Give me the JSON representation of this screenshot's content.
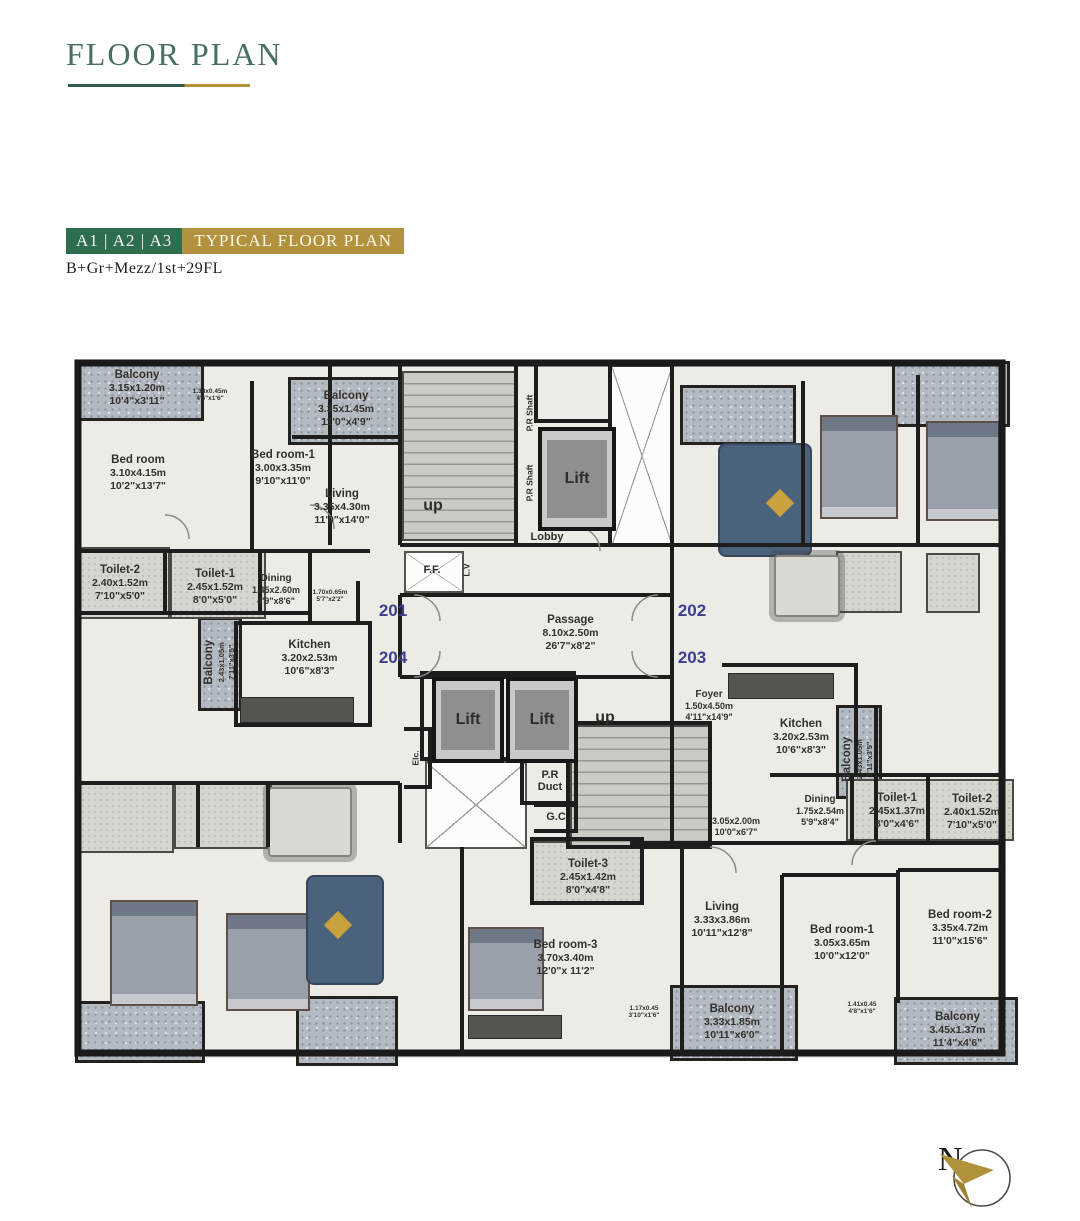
{
  "header": {
    "title": "FLOOR PLAN",
    "units_badge": "A1 | A2 | A3",
    "type_badge": "TYPICAL FLOOR PLAN",
    "floors": "B+Gr+Mezz/1st+29FL"
  },
  "compass": {
    "north_label": "N"
  },
  "colors": {
    "brand_green": "#2d6e4e",
    "brand_gold": "#b2923e",
    "title_green": "#47705e",
    "unit_number_blue": "#3d3e8e"
  },
  "plan": {
    "lift_label": "Lift",
    "unit_numbers": [
      {
        "label": "201",
        "x": 302,
        "y": 243,
        "w": 42,
        "h": 26
      },
      {
        "label": "204",
        "x": 302,
        "y": 290,
        "w": 42,
        "h": 26
      },
      {
        "label": "202",
        "x": 601,
        "y": 243,
        "w": 42,
        "h": 26
      },
      {
        "label": "203",
        "x": 601,
        "y": 290,
        "w": 42,
        "h": 26
      }
    ],
    "lifts": [
      {
        "x": 468,
        "y": 72,
        "w": 70,
        "h": 96
      },
      {
        "x": 362,
        "y": 322,
        "w": 64,
        "h": 78
      },
      {
        "x": 436,
        "y": 322,
        "w": 64,
        "h": 78
      }
    ],
    "service_labels": [
      {
        "label": "up",
        "x": 340,
        "y": 138,
        "w": 46,
        "h": 26,
        "big": true
      },
      {
        "label": "up",
        "x": 512,
        "y": 350,
        "w": 46,
        "h": 26,
        "big": true
      },
      {
        "label": "P.R Shaft",
        "x": 448,
        "y": 28,
        "w": 22,
        "h": 60,
        "vertical": true
      },
      {
        "label": "P.R Shaft",
        "x": 448,
        "y": 96,
        "w": 22,
        "h": 64,
        "vertical": true
      },
      {
        "label": "Lobby",
        "x": 448,
        "y": 172,
        "w": 58,
        "h": 20
      },
      {
        "label": "F.F.",
        "x": 336,
        "y": 197,
        "w": 52,
        "h": 36
      },
      {
        "label": "L.V",
        "x": 388,
        "y": 198,
        "w": 18,
        "h": 34,
        "vertical": true
      },
      {
        "label": "P.R\nDuct",
        "x": 454,
        "y": 404,
        "w": 52,
        "h": 44
      },
      {
        "label": "G.C",
        "x": 466,
        "y": 450,
        "w": 40,
        "h": 24
      },
      {
        "label": "Elc.",
        "x": 334,
        "y": 376,
        "w": 24,
        "h": 54,
        "vertical": true
      }
    ],
    "rooms": [
      {
        "name": "Balcony",
        "m": "3.15x1.20m",
        "ft": "10'4\"x3'11\"",
        "x": 8,
        "y": 8,
        "w": 118,
        "h": 50,
        "type": "balcony"
      },
      {
        "name": "",
        "m": "1.38x0.45m",
        "ft": "4'6\"x1'6\"",
        "x": 112,
        "y": 26,
        "w": 56,
        "h": 28,
        "type": "tiny"
      },
      {
        "name": "Bed room",
        "m": "3.10x4.15m",
        "ft": "10'2\"x13'7\"",
        "x": 12,
        "y": 88,
        "w": 112,
        "h": 60,
        "type": "room"
      },
      {
        "name": "Bed room-1",
        "m": "3.00x3.35m",
        "ft": "9'10\"x11'0\"",
        "x": 158,
        "y": 83,
        "w": 110,
        "h": 60,
        "type": "room"
      },
      {
        "name": "Balcony",
        "m": "3.35x1.45m",
        "ft": "11'0\"x4'9\"",
        "x": 222,
        "y": 28,
        "w": 108,
        "h": 52,
        "type": "balcony"
      },
      {
        "name": "Living",
        "m": "3.35x4.30m",
        "ft": "11'0\"x14'0\"",
        "x": 218,
        "y": 122,
        "w": 108,
        "h": 60,
        "type": "room"
      },
      {
        "name": "Toilet-2",
        "m": "2.40x1.52m",
        "ft": "7'10\"x5'0\"",
        "x": 6,
        "y": 200,
        "w": 88,
        "h": 56,
        "type": "room"
      },
      {
        "name": "Toilet-1",
        "m": "2.45x1.52m",
        "ft": "8'0\"x5'0\"",
        "x": 100,
        "y": 204,
        "w": 90,
        "h": 56,
        "type": "room"
      },
      {
        "name": "Dining",
        "m": "1.45x2.60m",
        "ft": "4'9\"x8'6\"",
        "x": 174,
        "y": 212,
        "w": 64,
        "h": 46,
        "type": "small"
      },
      {
        "name": "",
        "m": "1.70x0.65m",
        "ft": "5'7\"x2'2\"",
        "x": 230,
        "y": 226,
        "w": 60,
        "h": 30,
        "type": "tiny"
      },
      {
        "name": "Balcony",
        "m": "2.43x1.05m",
        "ft": "7'11\"x3'5\"",
        "x": 132,
        "y": 266,
        "w": 34,
        "h": 82,
        "type": "vroom"
      },
      {
        "name": "Kitchen",
        "m": "3.20x2.53m",
        "ft": "10'6\"x8'3\"",
        "x": 182,
        "y": 272,
        "w": 115,
        "h": 62,
        "type": "room"
      },
      {
        "name": "Passage",
        "m": "8.10x2.50m",
        "ft": "26'7\"x8'2\"",
        "x": 418,
        "y": 250,
        "w": 165,
        "h": 56,
        "type": "room"
      },
      {
        "name": "Foyer",
        "m": "1.50x4.50m",
        "ft": "4'11\"x14'9\"",
        "x": 606,
        "y": 330,
        "w": 66,
        "h": 42,
        "type": "small"
      },
      {
        "name": "Kitchen",
        "m": "3.20x2.53m",
        "ft": "10'6\"x8'3\"",
        "x": 675,
        "y": 352,
        "w": 112,
        "h": 60,
        "type": "room"
      },
      {
        "name": "Balcony",
        "m": "2.43x1.05m",
        "ft": "7'11\"x3'5\"",
        "x": 770,
        "y": 362,
        "w": 34,
        "h": 84,
        "type": "vroom"
      },
      {
        "name": "",
        "m": "3.05x2.00m",
        "ft": "10'0\"x6'7\"",
        "x": 622,
        "y": 452,
        "w": 88,
        "h": 40,
        "type": "small"
      },
      {
        "name": "Dining",
        "m": "1.75x2.54m",
        "ft": "5'9\"x8'4\"",
        "x": 710,
        "y": 430,
        "w": 80,
        "h": 52,
        "type": "small"
      },
      {
        "name": "Toilet-1",
        "m": "2.45x1.37m",
        "ft": "8'0\"x4'6\"",
        "x": 785,
        "y": 430,
        "w": 84,
        "h": 52,
        "type": "room"
      },
      {
        "name": "Toilet-2",
        "m": "2.40x1.52m",
        "ft": "7'10\"x5'0\"",
        "x": 862,
        "y": 430,
        "w": 80,
        "h": 54,
        "type": "room"
      },
      {
        "name": "Toilet-3",
        "m": "2.45x1.42m",
        "ft": "8'0\"x4'8\"",
        "x": 468,
        "y": 496,
        "w": 100,
        "h": 52,
        "type": "room"
      },
      {
        "name": "Bed room-3",
        "m": "3.70x3.40m",
        "ft": "12'0\"x 11'2\"",
        "x": 418,
        "y": 572,
        "w": 155,
        "h": 62,
        "type": "room"
      },
      {
        "name": "Living",
        "m": "3.33x3.86m",
        "ft": "10'11\"x12'8\"",
        "x": 598,
        "y": 535,
        "w": 108,
        "h": 60,
        "type": "room"
      },
      {
        "name": "Bed room-1",
        "m": "3.05x3.65m",
        "ft": "10'0\"x12'0\"",
        "x": 715,
        "y": 558,
        "w": 114,
        "h": 60,
        "type": "room"
      },
      {
        "name": "Bed room-2",
        "m": "3.35x4.72m",
        "ft": "11'0\"x15'6\"",
        "x": 833,
        "y": 543,
        "w": 114,
        "h": 60,
        "type": "room"
      },
      {
        "name": "Balcony",
        "m": "3.33x1.85m",
        "ft": "10'11\"x6'0\"",
        "x": 606,
        "y": 638,
        "w": 112,
        "h": 58,
        "type": "balcony"
      },
      {
        "name": "",
        "m": "1.17x0.45",
        "ft": "3'10\"x1'6\"",
        "x": 550,
        "y": 646,
        "w": 48,
        "h": 22,
        "type": "tiny"
      },
      {
        "name": "",
        "m": "1.41x0.45",
        "ft": "4'8\"x1'6\"",
        "x": 768,
        "y": 642,
        "w": 48,
        "h": 22,
        "type": "tiny"
      },
      {
        "name": "Balcony",
        "m": "3.45x1.37m",
        "ft": "11'4\"x4'6\"",
        "x": 830,
        "y": 648,
        "w": 115,
        "h": 54,
        "type": "balcony"
      }
    ]
  }
}
